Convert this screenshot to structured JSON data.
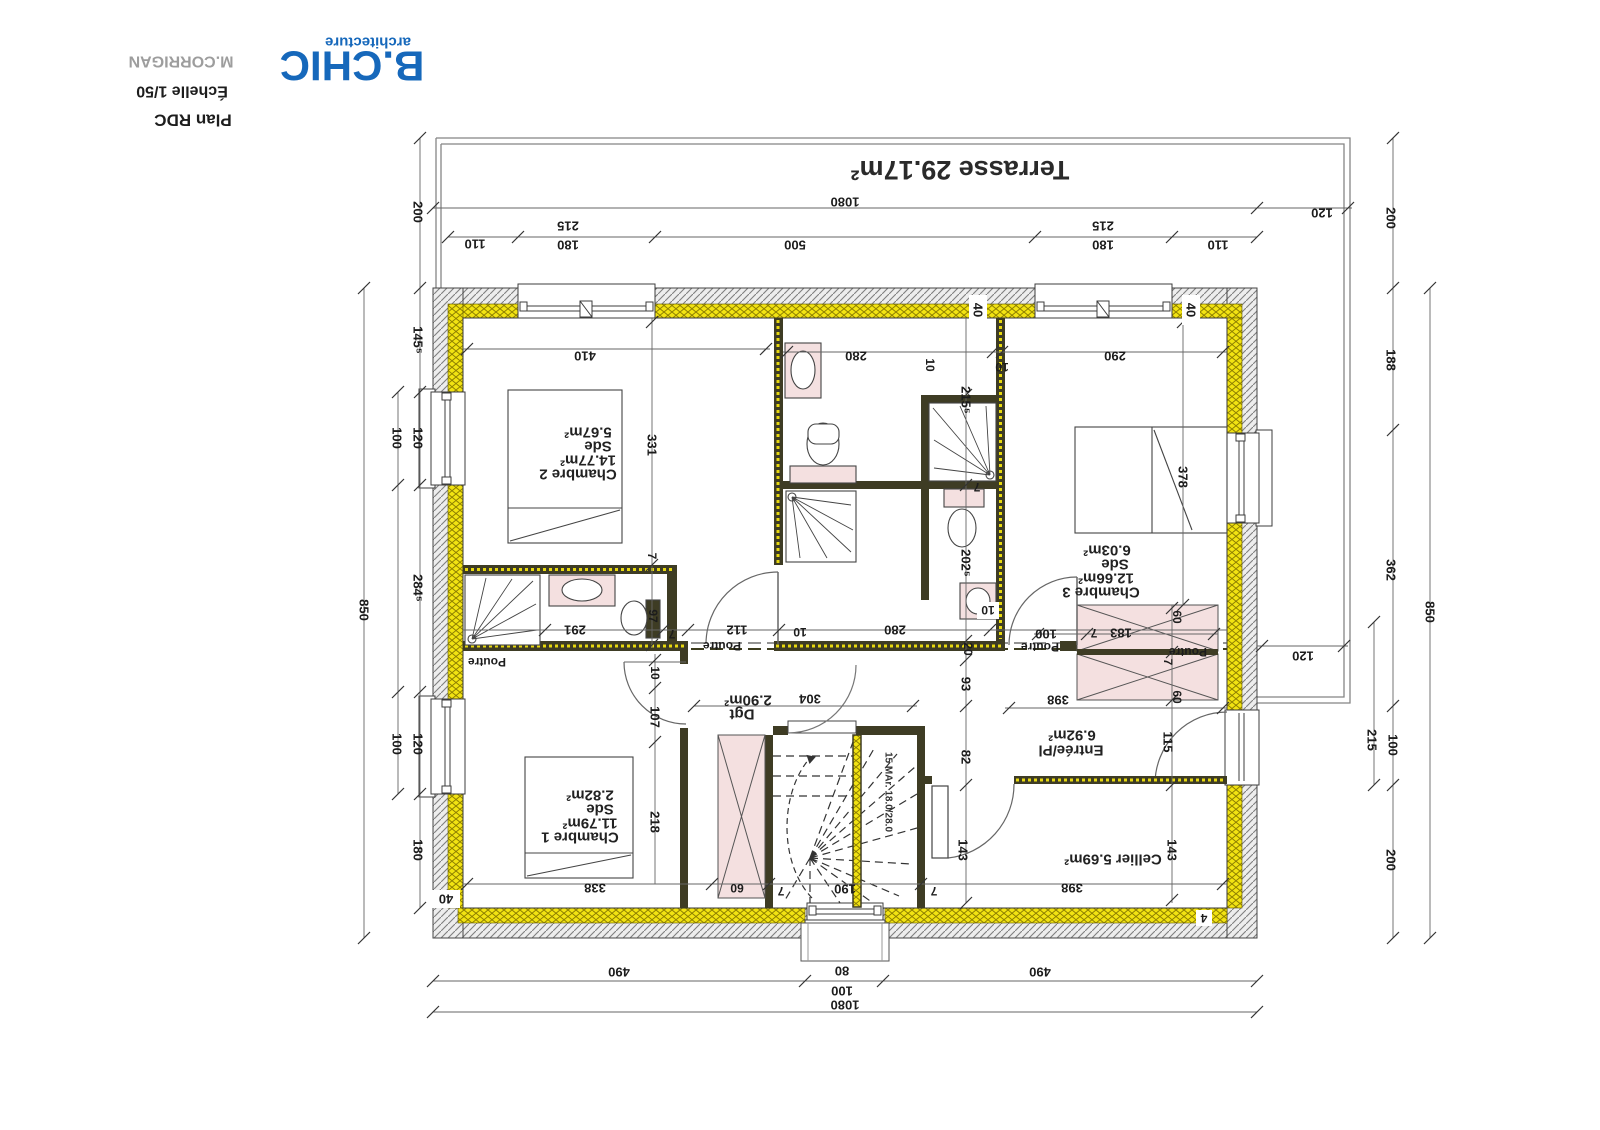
{
  "title_block": {
    "logo": "B.CHIC",
    "logo_sub": "architecture",
    "client": "M.CORRIGAN",
    "scale": "Échelle 1/50",
    "plan": "Plan RDC"
  },
  "rooms": {
    "terrasse": "Terrasse 29.17m²",
    "chambre2": [
      "Chambre 2",
      "14.77m²",
      "Sde",
      "5.67m²"
    ],
    "chambre3": [
      "Chambre 3",
      "12.66m²",
      "Sde",
      "6.03m²"
    ],
    "chambre1": [
      "Chambre 1",
      "11.79m²",
      "Sde",
      "2.82m²"
    ],
    "dgt": [
      "Dgt",
      "2.90m²"
    ],
    "entree": [
      "Entrée/Pl",
      "6.92m²"
    ],
    "cellier": "Cellier 5.69m²",
    "stair_note": "15 MAr. 18.0/28.0",
    "poutre": "Poutre"
  },
  "dims": {
    "t1080": "1080",
    "t120": "120",
    "t110L": "110",
    "t215L": "215",
    "t180L": "180",
    "t500": "500",
    "t215R": "215",
    "t180R": "180",
    "t110R": "110",
    "l200": "200",
    "l1455": "145⁵",
    "l120a": "120",
    "l100a": "100",
    "l2845": "284⁵",
    "l120b": "120",
    "l100b": "100",
    "l180": "180",
    "l850": "850",
    "r200t": "200",
    "r188": "188",
    "r362": "362",
    "r215": "215",
    "r100": "100",
    "r200b": "200",
    "r850": "850",
    "r120": "120",
    "b490L": "490",
    "b80": "80",
    "b100": "100",
    "b490R": "490",
    "b1080": "1080",
    "i410": "410",
    "i10a": "10",
    "i280t": "280",
    "i10b": "10",
    "i290": "290",
    "i331": "331",
    "i2155": "215⁵",
    "i378": "378",
    "i2025": "202⁵",
    "i291": "291",
    "i97": "97",
    "i7a": "7",
    "i7b": "7",
    "i112": "112",
    "i10c": "10",
    "i280b": "280",
    "i20": "20",
    "i93": "93",
    "i100": "100",
    "i7c": "7",
    "i183": "183",
    "i60a": "60",
    "i7d": "7",
    "i60b": "60",
    "i398a": "398",
    "i82": "82",
    "i115": "115",
    "i143a": "143",
    "i143b": "143",
    "i398b": "398",
    "i10d": "10",
    "i107": "107",
    "i218": "218",
    "i304": "304",
    "i338": "338",
    "i60c": "60",
    "i190": "190",
    "i7e": "7",
    "i7f": "7",
    "i7g": "7",
    "i10e": "10",
    "w40a": "40",
    "w40b": "40",
    "w40c": "40",
    "w4": "4"
  },
  "colors": {
    "logo_blue": "#1668bb",
    "insulation_yellow": "#f2e312",
    "hatch_gray": "#8a8a8a",
    "partition_olive": "#3e3c24",
    "fixture_pink": "#f4e0e0"
  }
}
